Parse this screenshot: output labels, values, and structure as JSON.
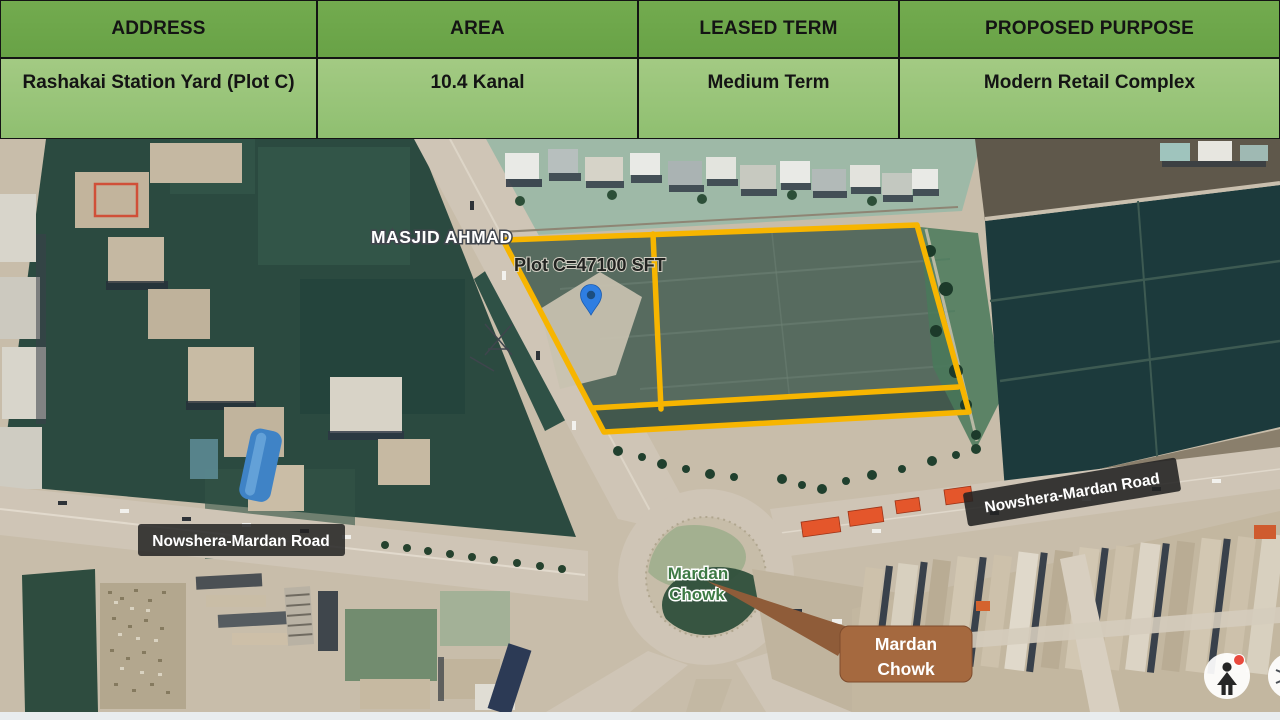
{
  "table": {
    "columns": [
      {
        "header": "ADDRESS",
        "value": "Rashakai Station Yard (Plot C)"
      },
      {
        "header": "AREA",
        "value": "10.4 Kanal"
      },
      {
        "header": "LEASED TERM",
        "value": "Medium Term"
      },
      {
        "header": "PROPOSED PURPOSE",
        "value": "Modern Retail Complex"
      }
    ],
    "colors": {
      "header_bg": "#6fa84e",
      "row_bg": "#9bc57d",
      "text": "#141414"
    }
  },
  "map": {
    "poi_label": "MASJID AHMAD",
    "plot_area_label": "Plot C=47100 SFT",
    "road_label": "Nowshera-Mardan Road",
    "junction_label": {
      "line1": "Mardan",
      "line2": "Chowk"
    },
    "callout": {
      "line1": "Mardan",
      "line2": "Chowk"
    },
    "colors": {
      "plot_outline": "#f7b500",
      "pin": "#2e7ee2",
      "junction_label_green": "#3d7a44",
      "road_label_bg": "#222222",
      "callout_bg": "#a5693f",
      "callout_arrow": "#8f5c39"
    }
  },
  "controls": {
    "pegman_icon": "pegman",
    "explore_icon": "compass",
    "notification_dot_color": "#e9493d"
  }
}
